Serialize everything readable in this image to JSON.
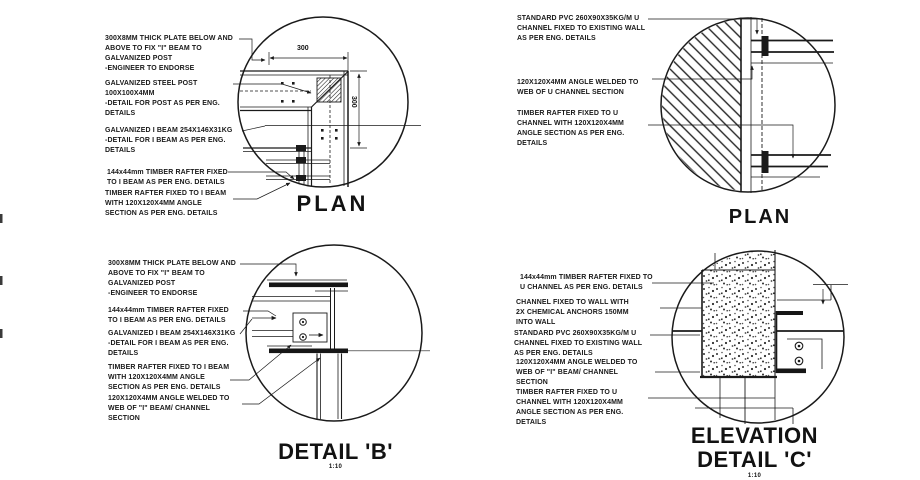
{
  "meta": {
    "background": "#ffffff",
    "ink": "#1a1a1a"
  },
  "quadrants": {
    "plan_left": {
      "title": "PLAN",
      "dim_width": "300",
      "dim_height": "300",
      "annotations": [
        "300X8MM THICK PLATE BELOW AND\nABOVE TO FIX \"I\" BEAM TO\nGALVANIZED POST\n-ENGINEER TO ENDORSE",
        "GALVANIZED STEEL POST\n100X100X4MM\n-DETAIL FOR POST AS PER ENG.\nDETAILS",
        "GALVANIZED I BEAM 254X146X31KG\n-DETAIL FOR I BEAM AS PER ENG.\nDETAILS",
        "144x44mm TIMBER RAFTER FIXED\nTO I BEAM AS PER ENG. DETAILS",
        "TIMBER RAFTER FIXED TO I BEAM\nWITH 120X120X4MM ANGLE\nSECTION AS PER ENG. DETAILS"
      ]
    },
    "plan_right": {
      "title": "PLAN",
      "annotations": [
        "STANDARD PVC 260X90X35KG/M U\nCHANNEL FIXED TO EXISTING WALL\nAS PER ENG. DETAILS",
        "120X120X4MM ANGLE WELDED TO\nWEB OF U CHANNEL SECTION",
        "TIMBER RAFTER FIXED TO U\nCHANNEL WITH 120X120X4MM\nANGLE SECTION AS PER ENG.\nDETAILS"
      ]
    },
    "detail_b": {
      "title": "DETAIL 'B'",
      "scale": "1:10",
      "annotations": [
        "300X8MM THICK PLATE BELOW AND\nABOVE TO FIX \"I\" BEAM TO\nGALVANIZED POST\n-ENGINEER TO ENDORSE",
        "144x44mm TIMBER RAFTER FIXED\nTO I BEAM AS PER ENG. DETAILS",
        "GALVANIZED I BEAM 254X146X31KG\n-DETAIL FOR I BEAM AS PER ENG.\nDETAILS",
        "TIMBER RAFTER FIXED TO I BEAM\nWITH 120X120X4MM ANGLE\nSECTION AS PER ENG. DETAILS",
        "120X120X4MM ANGLE WELDED TO\nWEB OF \"I\" BEAM/ CHANNEL\nSECTION"
      ]
    },
    "elevation_c": {
      "title": "ELEVATION\nDETAIL 'C'",
      "scale": "1:10",
      "annotations": [
        "144x44mm TIMBER RAFTER FIXED TO\nU CHANNEL AS PER ENG. DETAILS",
        "CHANNEL FIXED TO WALL WITH\n2X CHEMICAL ANCHORS 150MM\nINTO WALL",
        "STANDARD PVC 260X90X35KG/M U\nCHANNEL FIXED TO EXISTING WALL\nAS PER ENG. DETAILS",
        "120X120X4MM ANGLE WELDED TO\nWEB OF \"I\" BEAM/ CHANNEL\nSECTION",
        "TIMBER RAFTER FIXED TO U\nCHANNEL WITH 120X120X4MM\nANGLE SECTION AS PER ENG.\nDETAILS"
      ]
    }
  }
}
